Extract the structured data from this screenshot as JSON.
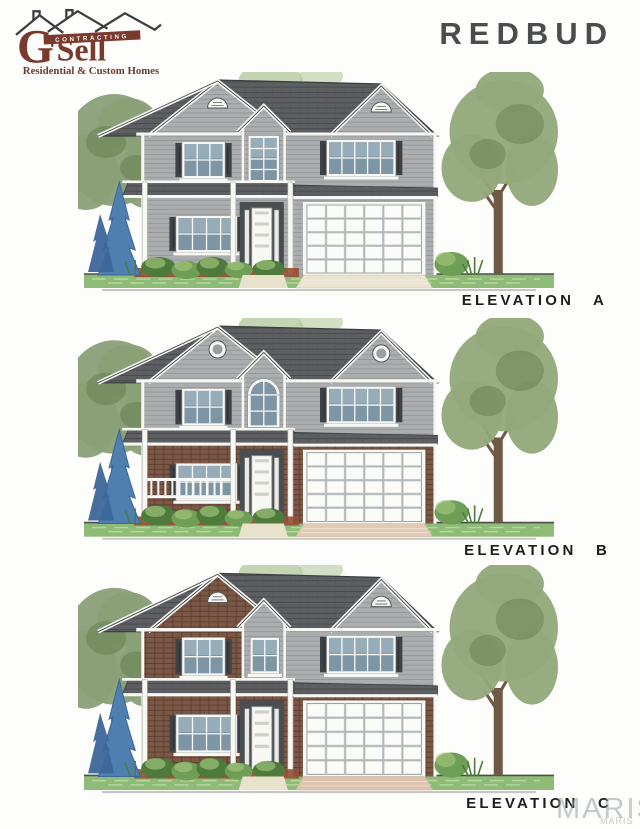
{
  "header": {
    "title": "REDBUD"
  },
  "logo": {
    "brand_g": "G",
    "brand_rest": "'Sell",
    "banner": "CONTRACTING",
    "tagline": "Residential & Custom Homes"
  },
  "elevations": [
    {
      "id": "A",
      "label": "ELEVATION A",
      "house": {
        "upper_left_material": "siding",
        "lower_left_material": "siding",
        "garage_material": "siding",
        "gable_vent": "half-round",
        "entry_window": "tall-rectangular",
        "porch_railing": false,
        "driveway_color": "#eae3d0"
      }
    },
    {
      "id": "B",
      "label": "ELEVATION B",
      "house": {
        "upper_left_material": "siding",
        "lower_left_material": "brick",
        "garage_material": "brick",
        "gable_vent": "round",
        "entry_window": "arched",
        "porch_railing": true,
        "driveway_color": "#e2cbb2"
      }
    },
    {
      "id": "C",
      "label": "ELEVATION C",
      "house": {
        "upper_left_material": "brick",
        "lower_left_material": "brick",
        "garage_material": "brick",
        "gable_vent": "half-round",
        "entry_window": "rectangular",
        "porch_railing": false,
        "driveway_color": "#dec2ad"
      }
    }
  ],
  "watermark": {
    "large": "MARIS",
    "small": "MARIS"
  },
  "colors": {
    "maroon": "#7a3a2e",
    "roofline_gray": "#3e3e40",
    "title_color": "#4a4c4e",
    "label_color": "#1d1d1d",
    "watermark_color": "#9aa0a5",
    "roof": "#5d5f62",
    "siding": "#abadaf",
    "brick": "#7b5745",
    "trim": "#f7f7f3",
    "shutter": "#3e4246",
    "glass": "#7e95a6",
    "lawn": "#8fbb78",
    "lawn_light": "#b8d79c",
    "ground_line": "#4c4f45",
    "foliage": "#8aa078",
    "foliage2": "#92a87a",
    "foliage_dark": "#66804f",
    "foliage_light": "#b7cba2",
    "bush": "#6f9e57",
    "bush_dark": "#4e7a3c",
    "bush_light": "#9cc277",
    "spruce": "#4f7fae",
    "spruce_dark": "#3c679a",
    "trunk": "#6e5a44",
    "mulch": "#954f35"
  }
}
